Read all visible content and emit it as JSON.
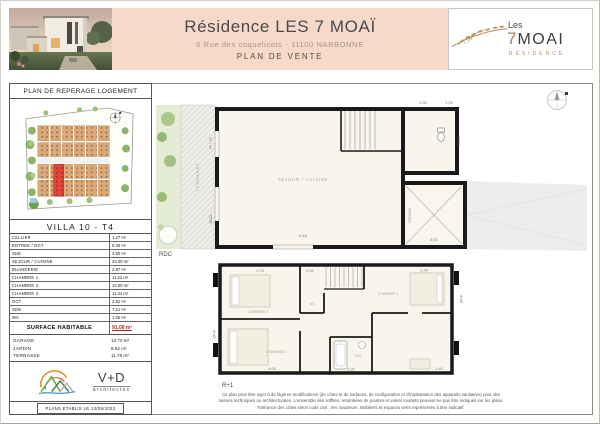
{
  "header": {
    "title": "Résidence LES 7 MOAÏ",
    "address": "6 Rue des coquelicots - 11100  NARBONNE",
    "doc_type": "PLAN DE VENTE"
  },
  "brand": {
    "top": "Les",
    "num": "7",
    "word": "MOAI",
    "sub": "RÉSIDENCE"
  },
  "sidebar": {
    "title": "PLAN DE REPERAGE LOGEMENT",
    "villa": "VILLA  10  - T4",
    "rooms": [
      {
        "label": "CELLIER",
        "value": "1.27 m²"
      },
      {
        "label": "ENTREE / DGT",
        "value": "5.36 m²"
      },
      {
        "label": "SDE",
        "value": "4.50 m²"
      },
      {
        "label": "SEJOUR / CUISINE",
        "value": "33.40 m²"
      },
      {
        "label": "BUANDERIE",
        "value": "2.87 m²"
      },
      {
        "label": "CHAMBRE 1",
        "value": "11.22 m²"
      },
      {
        "label": "CHAMBRE 2",
        "value": "10.00 m²"
      },
      {
        "label": "CHAMBRE 3",
        "value": "11.34 m²"
      },
      {
        "label": "DGT",
        "value": "2.82 m²"
      },
      {
        "label": "SDB",
        "value": "7.21 m²"
      },
      {
        "label": "WC",
        "value": "1.05 m²"
      }
    ],
    "surface_label": "SURFACE HABITABLE",
    "surface_value": "91.00 m²",
    "annexes": [
      {
        "label": "GARAGE",
        "value": "13.70 m²"
      },
      {
        "label": "JARDIN",
        "value": "8.52 m²"
      },
      {
        "label": "TERRASSE",
        "value": "11.76 m²"
      }
    ],
    "vd_name": "V+D",
    "vd_sub": "architectes",
    "date": "PLANS ETABLIS LE  13/06/2023"
  },
  "plans": {
    "rdc": {
      "label": "RDC",
      "room_sejour": "SEJOUR / CUISINE",
      "terrasse": "TERRASSE",
      "garage": "GARAGE",
      "seuil_a": "SEUIL",
      "seuil_b": "SEUIL",
      "pfcf": "PF + CF",
      "dim_width": "6.18",
      "dim_garage": "5.00",
      "dim_top_a": "2.30",
      "dim_top_b": "1.00"
    },
    "r1": {
      "label": "R+1",
      "ch1": "CHAMBRE 1",
      "ch2": "CHAMBRE 2",
      "ch3": "CHAMBRE 3",
      "sdb": "SDB",
      "wc": "WC",
      "cf_left": "CF+F",
      "cf_right": "CF+F",
      "dims_top": [
        "2.74",
        "0.92",
        "2.40"
      ],
      "dims_bottom": [
        "4.00",
        "1.97",
        "2.40"
      ]
    }
  },
  "footer": {
    "line1": "Ce plan peut être sujet à de légères modifications (de côtes et de surfaces, de configuration et d'implantation des appareils sanitaires) pour des",
    "line2": "raisons techniques ou architecturales. L'ensemble des soffites, retombées de poutres et volets roulants peuvent ne pas être indiqués sur les plans.",
    "line3": "Tolérance des côtes selon code civil : 5% maximum. Mobiliers et espaces verts représentés à titre indicatif."
  }
}
